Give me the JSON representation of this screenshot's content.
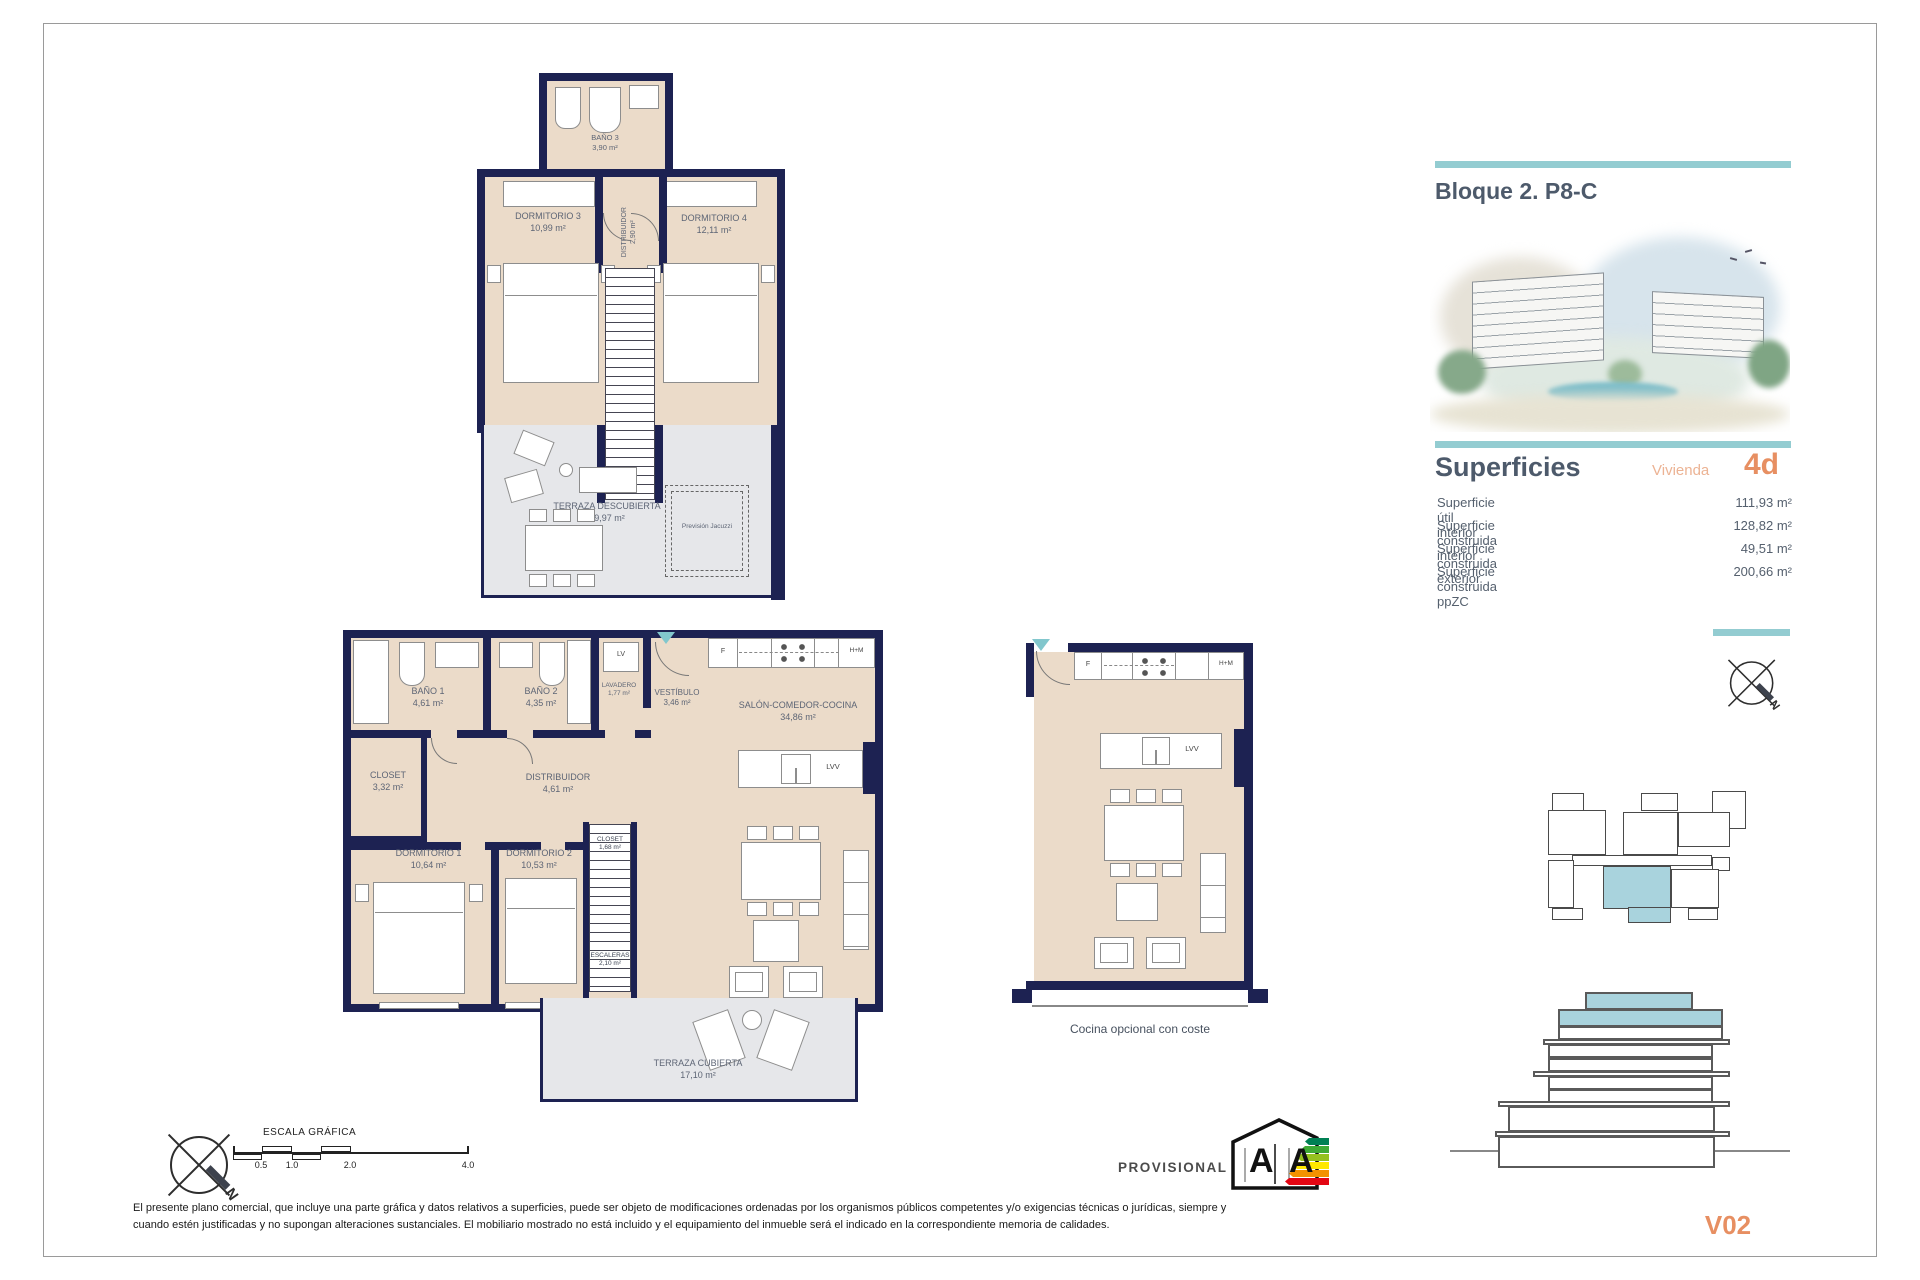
{
  "panel": {
    "title": "Bloque 2. P8-C",
    "superficies": "Superficies",
    "vivienda_label": "Vivienda",
    "vivienda_value": "4d",
    "rows": [
      {
        "label": "Superficie útil interior",
        "value": "111,93 m²"
      },
      {
        "label": "Superficie construida interior",
        "value": "128,82 m²"
      },
      {
        "label": "Superficie construida exterior",
        "value": "49,51 m²"
      },
      {
        "label": "Superficie construida ppZC",
        "value": "200,66 m²"
      }
    ],
    "version": "V02"
  },
  "up": {
    "bano3": {
      "n": "BAÑO 3",
      "a": "3,90 m²"
    },
    "dorm3": {
      "n": "DORMITORIO 3",
      "a": "10,99 m²"
    },
    "dorm4": {
      "n": "DORMITORIO 4",
      "a": "12,11 m²"
    },
    "dist": {
      "n": "DISTRIBUIDOR",
      "a": "2,90 m²"
    },
    "terraza": {
      "n": "TERRAZA DESCUBIERTA",
      "a": "29,97 m²"
    },
    "jacuzzi": "Previsión Jacuzzi"
  },
  "lp": {
    "bano1": {
      "n": "BAÑO 1",
      "a": "4,61 m²"
    },
    "bano2": {
      "n": "BAÑO 2",
      "a": "4,35 m²"
    },
    "lavadero": {
      "n": "LAVADERO",
      "a": "1,77 m²"
    },
    "vestibulo": {
      "n": "VESTÍBULO",
      "a": "3,46 m²"
    },
    "salon": {
      "n": "SALÓN-COMEDOR-COCINA",
      "a": "34,86 m²"
    },
    "closet": {
      "n": "CLOSET",
      "a": "3,32 m²"
    },
    "dist": {
      "n": "DISTRIBUIDOR",
      "a": "4,61 m²"
    },
    "dorm1": {
      "n": "DORMITORIO 1",
      "a": "10,64 m²"
    },
    "dorm2": {
      "n": "DORMITORIO 2",
      "a": "10,53 m²"
    },
    "closet2": {
      "n": "CLOSET",
      "a": "1,68 m²"
    },
    "escaleras": {
      "n": "ESCALERAS",
      "a": "2,10 m²"
    },
    "terraza": {
      "n": "TERRAZA CUBIERTA",
      "a": "17,10 m²"
    },
    "lv": "LV",
    "lvv": "LVV",
    "f": "F",
    "hm": "H+M"
  },
  "op": {
    "caption": "Cocina opcional con coste",
    "lvv": "LVV",
    "f": "F",
    "hm": "H+M"
  },
  "scale": {
    "title": "ESCALA GRÁFICA",
    "ticks": [
      "0.5",
      "1.0",
      "2.0",
      "4.0"
    ]
  },
  "compass": {
    "n": "N"
  },
  "energy": {
    "a1": "A",
    "a2": "A"
  },
  "footer": {
    "provisional": "PROVISIONAL",
    "line1": "El presente plano comercial, que incluye una parte gráfica y datos relativos a superficies, puede ser objeto de modificaciones ordenadas por los organismos públicos competentes y/o exigencias técnicas o jurídicas, siempre y",
    "line2": "cuando estén justificadas y no supongan alteraciones sustanciales. El mobiliario mostrado no está incluido y el equipamiento del inmueble será el indicado en la correspondiente memoria de calidades."
  }
}
